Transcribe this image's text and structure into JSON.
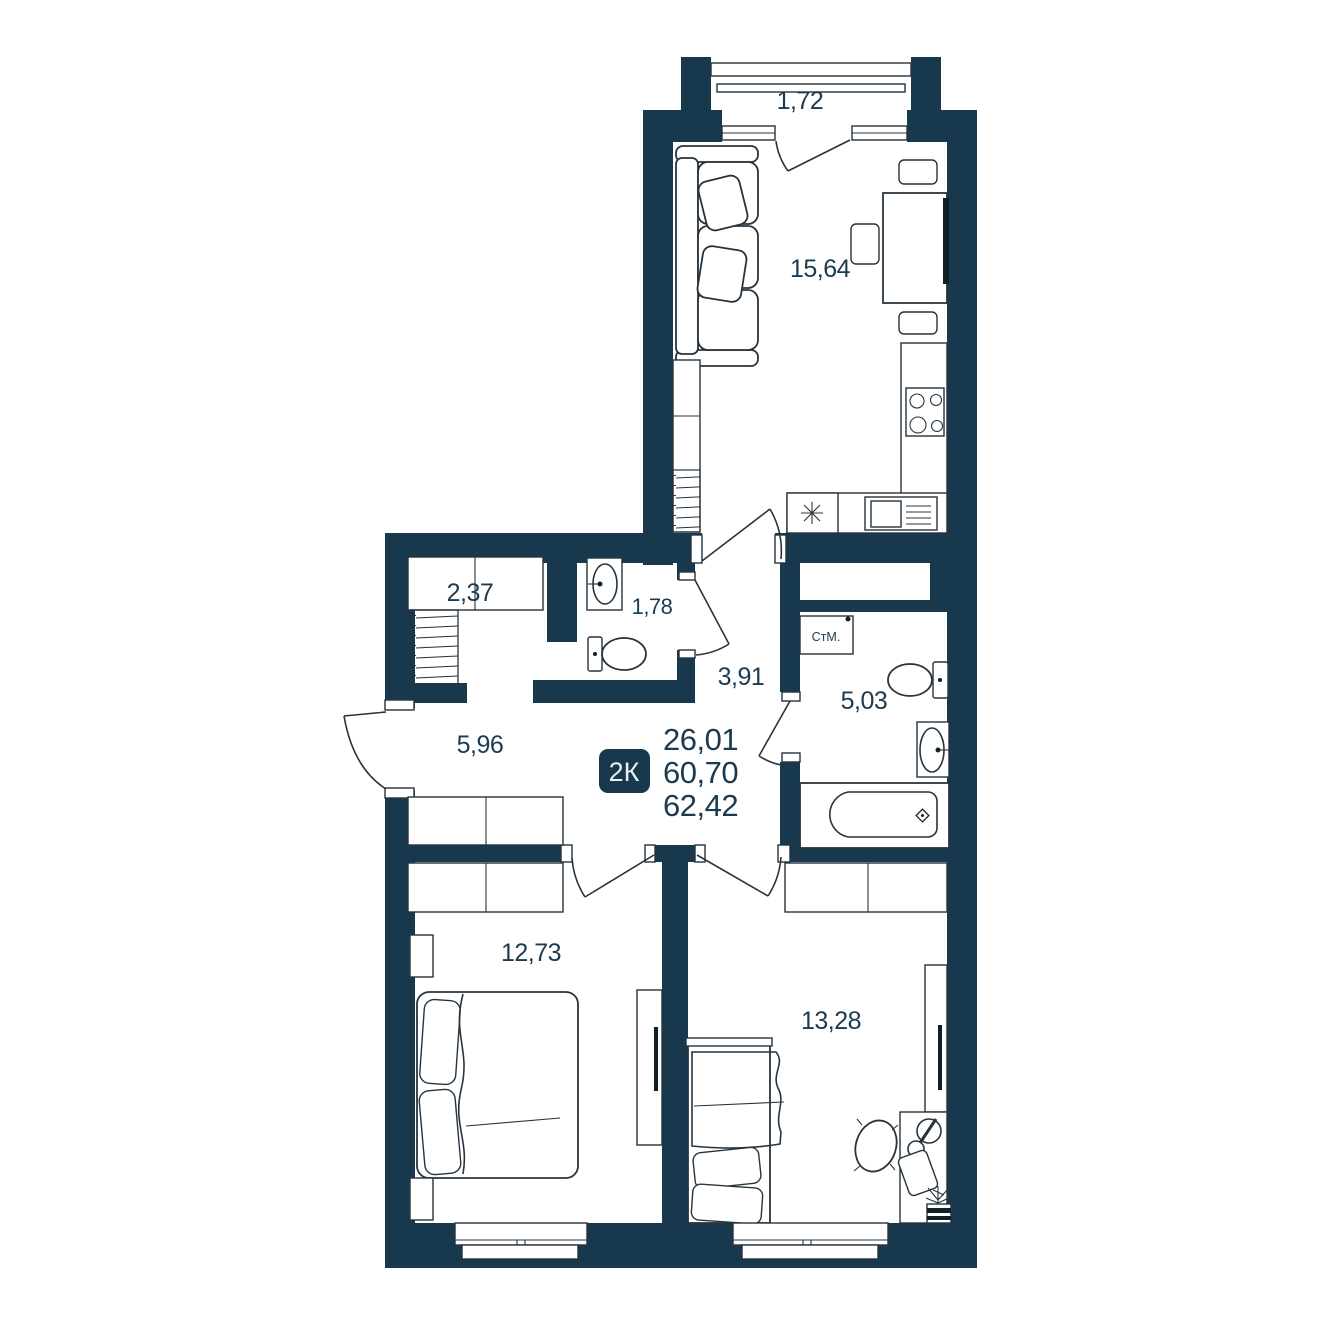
{
  "badge": {
    "label": "2К"
  },
  "summary": {
    "values": [
      "26,01",
      "60,70",
      "62,42"
    ]
  },
  "rooms": {
    "balcony": {
      "area": "1,72"
    },
    "kitchen_living": {
      "area": "15,64"
    },
    "closet": {
      "area": "2,37"
    },
    "wc": {
      "area": "1,78"
    },
    "hallway": {
      "area": "3,91"
    },
    "bathroom": {
      "area": "5,03"
    },
    "entry": {
      "area": "5,96"
    },
    "bedroom1": {
      "area": "12,73"
    },
    "bedroom2": {
      "area": "13,28"
    }
  },
  "appliances": {
    "washing_machine": "СтМ."
  },
  "colors": {
    "wall": "#17384D",
    "text": "#1C3A50",
    "line": "#28343D"
  }
}
